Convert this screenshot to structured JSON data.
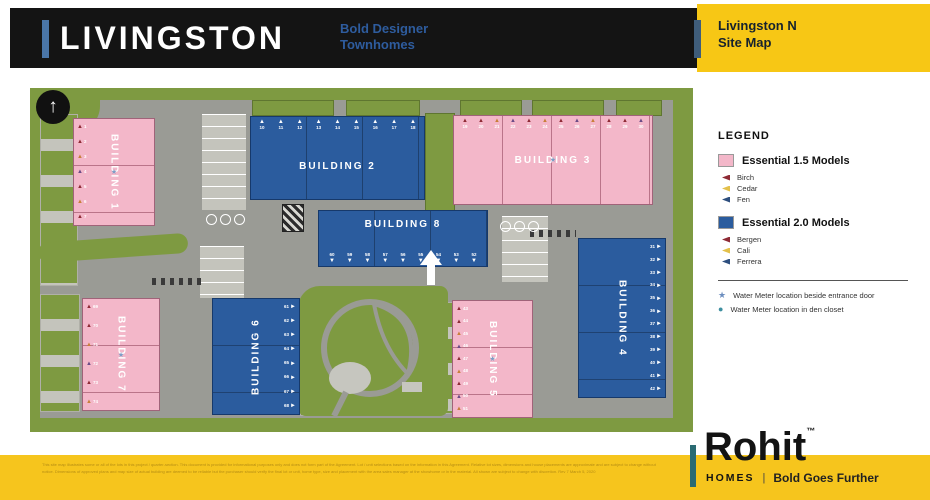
{
  "header": {
    "title": "LIVINGSTON",
    "tagline_line1": "Bold Designer",
    "tagline_line2": "Townhomes",
    "badge_line1": "Livingston N",
    "badge_line2": "Site Map"
  },
  "icons": {
    "north_arrow": "↑",
    "star": "★",
    "dot": "●"
  },
  "map": {
    "marker_glyphs": {
      "top": "▲",
      "bottom": "▼",
      "left": "▲",
      "right": "►"
    },
    "buildings": [
      {
        "label": "BUILDING 1",
        "model": "Essential 1.5",
        "units": [
          "1",
          "2",
          "3",
          "4",
          "5",
          "6",
          "7"
        ]
      },
      {
        "label": "BUILDING 2",
        "model": "Essential 2.0",
        "units": [
          "10",
          "11",
          "12",
          "13",
          "14",
          "15",
          "16",
          "17",
          "18"
        ]
      },
      {
        "label": "BUILDING 3",
        "model": "Essential 1.5",
        "units": [
          "19",
          "20",
          "21",
          "22",
          "23",
          "24",
          "25",
          "26",
          "27",
          "28",
          "29",
          "30"
        ]
      },
      {
        "label": "BUILDING 4",
        "model": "Essential 2.0",
        "units": [
          "31",
          "32",
          "33",
          "34",
          "35",
          "36",
          "37",
          "38",
          "39",
          "40",
          "41",
          "42"
        ]
      },
      {
        "label": "BUILDING 5",
        "model": "Essential 1.5",
        "units": [
          "43",
          "44",
          "45",
          "46",
          "47",
          "48",
          "49",
          "50",
          "51"
        ]
      },
      {
        "label": "BUILDING 6",
        "model": "Essential 2.0",
        "units": [
          "61",
          "62",
          "63",
          "64",
          "65",
          "66",
          "67",
          "68"
        ]
      },
      {
        "label": "BUILDING 7",
        "model": "Essential 1.5",
        "units": [
          "69",
          "70",
          "71",
          "72",
          "73",
          "74"
        ]
      },
      {
        "label": "BUILDING 8",
        "model": "Essential 2.0",
        "units": [
          "60",
          "59",
          "58",
          "57",
          "56",
          "55",
          "54",
          "53",
          "52"
        ]
      }
    ]
  },
  "legend": {
    "heading": "LEGEND",
    "groups": [
      {
        "swatch": "#f3b7c9",
        "title": "Essential 1.5 Models",
        "items": [
          {
            "name": "Birch",
            "color": "#8e2a35"
          },
          {
            "name": "Cedar",
            "color": "#e3c04b"
          },
          {
            "name": "Fen",
            "color": "#2d4e7e"
          }
        ]
      },
      {
        "swatch": "#2b5c9e",
        "title": "Essential 2.0 Models",
        "items": [
          {
            "name": "Bergen",
            "color": "#8e2a35"
          },
          {
            "name": "Cali",
            "color": "#e3c04b"
          },
          {
            "name": "Ferrera",
            "color": "#2d4e7e"
          }
        ]
      }
    ],
    "notes": [
      {
        "color": "#6c8ebf",
        "text": "Water Meter location beside entrance door"
      },
      {
        "color": "#3e8fa0",
        "text": "Water Meter location in den closet"
      }
    ]
  },
  "footer": {
    "brand": "Rohit",
    "brand_tm": "™",
    "brand_sub": "HOMES",
    "brand_pipe": "|",
    "brand_tagline": "Bold Goes Further",
    "disclaimer": "This site map illustrates some or all of the lots in this project / quarter-section. This document is provided for informational purposes only and does not form part of the Agreement. Lot / unit selections based on the information in this Agreement. Relative lot sizes, dimensions and house placements are approximate and are subject to change without notice. Dimensions of approved plans and map size of actual building are deemed to be reliable but the purchaser should verify the final lot or unit, home type, size and placement with the area sales manager at the showhome or in the material. All shown are subject to change with discretion. Rev 7 March 5, 2020"
  }
}
